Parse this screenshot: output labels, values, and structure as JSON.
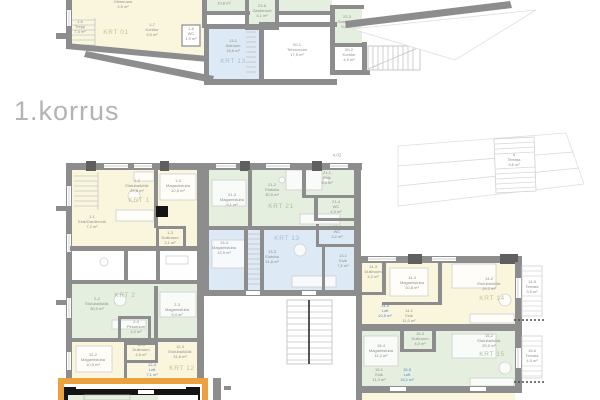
{
  "title": {
    "floor_label": "1.korrus"
  },
  "colors": {
    "background": "#ffffff",
    "wall_gray": "#8d8d8d",
    "wall_dark_pier": "#5f5f5f",
    "selected_wall_black": "#141414",
    "apartment_yellow": "#faf6dd",
    "apartment_green": "#e4efdf",
    "apartment_blue": "#dde9f4",
    "highlight_orange": "#eaa13e",
    "room_text_gray": "#8e8e8e",
    "loft_text_blue": "#5b7ec7",
    "krt_label_yellow": "#cdc091",
    "krt_label_green": "#a6c49f",
    "krt_label_blue": "#a3bed9",
    "title_gray": "#b3b3b3"
  },
  "apartments": [
    {
      "id": "KRT 01",
      "fill": "yellow",
      "plan": "upper"
    },
    {
      "id": "KRT 13",
      "fill": "blue",
      "plan": "upper"
    },
    {
      "id": "KRT 1",
      "fill": "yellow",
      "plan": "lower"
    },
    {
      "id": "KRT 2",
      "fill": "green",
      "plan": "lower"
    },
    {
      "id": "KRT 12",
      "fill": "yellow",
      "plan": "lower"
    },
    {
      "id": "KRT 21",
      "fill": "green",
      "plan": "lower"
    },
    {
      "id": "KRT 13",
      "fill": "blue",
      "plan": "lower"
    },
    {
      "id": "KRT 14",
      "fill": "yellow",
      "plan": "lower"
    },
    {
      "id": "KRT 15",
      "fill": "green",
      "plan": "lower"
    }
  ],
  "labels": [
    {
      "id": "room-1-08-olmeruum",
      "x": 123,
      "y": 2,
      "lines": [
        "1-08",
        "Olmeruum",
        "2,5 m²"
      ]
    },
    {
      "id": "room-1-6-trepp",
      "x": 80,
      "y": 27,
      "lines": [
        "1-6",
        "Trepp",
        "7,4 m²"
      ]
    },
    {
      "id": "apt-label-krt-01",
      "x": 116,
      "y": 33,
      "lines": [
        "KRT 01"
      ],
      "cls": "apt-yellow"
    },
    {
      "id": "room-1-7-koridor",
      "x": 152,
      "y": 30,
      "lines": [
        "1-7",
        "Koridor",
        "9,5 m²"
      ]
    },
    {
      "id": "room-1-8-wc",
      "x": 191,
      "y": 34,
      "lines": [
        "1-8",
        "WC",
        "1,9 m²"
      ]
    },
    {
      "id": "room-upper-cut-area",
      "x": 224,
      "y": 4,
      "lines": [
        "10,8 m²"
      ]
    },
    {
      "id": "room-23-6-garderoob",
      "x": 262,
      "y": 11,
      "lines": [
        "23-6",
        "Garderoob",
        "4,1 m²"
      ]
    },
    {
      "id": "room-22-3-garderoob",
      "x": 347,
      "y": 22,
      "lines": [
        "22-3",
        "Garderoob",
        "5,8 m²"
      ]
    },
    {
      "id": "room-13-1-abiruum",
      "x": 233,
      "y": 46,
      "lines": [
        "13-1",
        "Abiruum",
        "16,6 m²"
      ]
    },
    {
      "id": "apt-label-krt-13-upper",
      "x": 233,
      "y": 62,
      "lines": [
        "KRT 13"
      ],
      "cls": "apt-blue"
    },
    {
      "id": "room-00-1-tehnoruum",
      "x": 297,
      "y": 50,
      "lines": [
        "00-1",
        "Tehnoruum",
        "17,5 m²"
      ]
    },
    {
      "id": "room-00-2-koridor",
      "x": 349,
      "y": 55,
      "lines": [
        "00-2",
        "Koridor",
        "4,5 m²"
      ]
    },
    {
      "id": "level-marker-4-02",
      "x": 337,
      "y": 155,
      "lines": [
        "4.02"
      ],
      "cls": "marker"
    },
    {
      "id": "roof-terrace",
      "x": 514,
      "y": 160,
      "lines": [
        "6",
        "Terrass",
        "9,6 m²"
      ]
    },
    {
      "id": "room-1-2-elutuba",
      "x": 137,
      "y": 186,
      "lines": [
        "1-2",
        "Elutuba/köök",
        "29,6 m²"
      ]
    },
    {
      "id": "apt-label-krt-1",
      "x": 139,
      "y": 201,
      "lines": [
        "KRT 1"
      ],
      "cls": "apt-yellow"
    },
    {
      "id": "room-1-4-magamistuba",
      "x": 178,
      "y": 186,
      "lines": [
        "1-4",
        "Magamistuba",
        "10,5 m²"
      ]
    },
    {
      "id": "room-1-1-esik",
      "x": 92,
      "y": 222,
      "lines": [
        "1-1",
        "Esik/Garderoob",
        "7,2 m²"
      ]
    },
    {
      "id": "room-1-3-dusiruum",
      "x": 170,
      "y": 238,
      "lines": [
        "1-3",
        "Duširuum",
        "3,1 m²"
      ]
    },
    {
      "id": "room-2-2-elutuba",
      "x": 97,
      "y": 304,
      "lines": [
        "2-2",
        "Elutuba/köök",
        "30,0 m²"
      ]
    },
    {
      "id": "apt-label-krt-2",
      "x": 125,
      "y": 296,
      "lines": [
        "KRT 2"
      ],
      "cls": "apt-green"
    },
    {
      "id": "room-2-3-magamistuba",
      "x": 177,
      "y": 310,
      "lines": [
        "2-3",
        "Magamistuba",
        "9,4 m²"
      ]
    },
    {
      "id": "room-2-4-pesuruum",
      "x": 136,
      "y": 327,
      "lines": [
        "2-4",
        "Pesuruum",
        "4,0 m²"
      ]
    },
    {
      "id": "room-12-2-magamistuba",
      "x": 93,
      "y": 360,
      "lines": [
        "12-2",
        "Magamistuba",
        "10,9 m²"
      ]
    },
    {
      "id": "room-12-5-dusiruum",
      "x": 141,
      "y": 350,
      "lines": [
        "12-5",
        "Duširuum",
        "4,5 m²"
      ]
    },
    {
      "id": "room-12-4-loft",
      "x": 152,
      "y": 370,
      "lines": [
        "12-4",
        "Loft",
        "7,1 m²"
      ],
      "cls": "loft"
    },
    {
      "id": "room-12-3-elutuba",
      "x": 180,
      "y": 352,
      "lines": [
        "12-3",
        "Elutuba/köök",
        "31,8 m²"
      ]
    },
    {
      "id": "apt-label-krt-12",
      "x": 182,
      "y": 369,
      "lines": [
        "KRT 12"
      ],
      "cls": "apt-yellow"
    },
    {
      "id": "room-21-3-magamistuba",
      "x": 232,
      "y": 200,
      "lines": [
        "21-3",
        "Magamistuba",
        "9,1 m²"
      ]
    },
    {
      "id": "room-21-2-elutuba",
      "x": 272,
      "y": 190,
      "lines": [
        "21-2",
        "Elutuba",
        "30,5 m²"
      ]
    },
    {
      "id": "apt-label-krt-21",
      "x": 281,
      "y": 207,
      "lines": [
        "KRT 21"
      ],
      "cls": "apt-green"
    },
    {
      "id": "room-21-1-esik",
      "x": 327,
      "y": 178,
      "lines": [
        "21-1",
        "Esik",
        "6,0 m²"
      ]
    },
    {
      "id": "room-21-4-wc",
      "x": 336,
      "y": 207,
      "lines": [
        "21-4",
        "WC",
        "4,3 m²"
      ]
    },
    {
      "id": "room-13-4-magamistuba",
      "x": 224,
      "y": 248,
      "lines": [
        "13-4",
        "Magamistuba",
        "13,5 m²"
      ]
    },
    {
      "id": "apt-label-krt-13",
      "x": 287,
      "y": 239,
      "lines": [
        "KRT 13"
      ],
      "cls": "apt-blue"
    },
    {
      "id": "room-13-3-elutuba",
      "x": 272,
      "y": 257,
      "lines": [
        "13-3",
        "Elutuba",
        "31,8 m²"
      ]
    },
    {
      "id": "room-13-2-wc",
      "x": 337,
      "y": 232,
      "lines": [
        "13-2",
        "WC",
        "3,2 m²"
      ]
    },
    {
      "id": "room-13-1-esik",
      "x": 343,
      "y": 261,
      "lines": [
        "13-1",
        "Esik",
        "7,6 m²"
      ]
    },
    {
      "id": "room-14-3-dusiruum",
      "x": 373,
      "y": 272,
      "lines": [
        "14-3",
        "Duširuum",
        "4,2 m²"
      ]
    },
    {
      "id": "room-14-4-magamistuba",
      "x": 412,
      "y": 283,
      "lines": [
        "14-4",
        "Magamistuba",
        "10,8 m²"
      ]
    },
    {
      "id": "room-14-5-loft",
      "x": 385,
      "y": 311,
      "lines": [
        "14-5",
        "Loft",
        "10,5 m²"
      ],
      "cls": "loft"
    },
    {
      "id": "room-14-1-esik",
      "x": 409,
      "y": 316,
      "lines": [
        "14-1",
        "Esik",
        "11,0 m²"
      ]
    },
    {
      "id": "room-14-2-elutuba",
      "x": 489,
      "y": 284,
      "lines": [
        "14-2",
        "Elutuba/köök",
        "29,2 m²"
      ]
    },
    {
      "id": "apt-label-krt-14",
      "x": 492,
      "y": 299,
      "lines": [
        "KRT 14"
      ],
      "cls": "apt-yellow"
    },
    {
      "id": "terrace-14-6",
      "x": 532,
      "y": 287,
      "lines": [
        "14-6",
        "Terrass",
        "3,5 m²"
      ]
    },
    {
      "id": "room-15-3-dusiruum",
      "x": 420,
      "y": 339,
      "lines": [
        "15-3",
        "Duširuum",
        "4,0 m²"
      ]
    },
    {
      "id": "room-15-4-magamistuba",
      "x": 381,
      "y": 351,
      "lines": [
        "15-4",
        "Magamistuba",
        "11,2 m²"
      ]
    },
    {
      "id": "room-15-1-esik",
      "x": 379,
      "y": 375,
      "lines": [
        "15-1",
        "Esik",
        "11,3 m²"
      ]
    },
    {
      "id": "room-15-5-loft",
      "x": 407,
      "y": 375,
      "lines": [
        "15-5",
        "Loft",
        "16,1 m²"
      ],
      "cls": "loft"
    },
    {
      "id": "room-15-2-elutuba",
      "x": 489,
      "y": 341,
      "lines": [
        "15-2",
        "Elutuba/köök",
        "29,0 m²"
      ]
    },
    {
      "id": "apt-label-krt-15",
      "x": 492,
      "y": 355,
      "lines": [
        "KRT 15"
      ],
      "cls": "apt-green"
    },
    {
      "id": "terrace-15-6",
      "x": 532,
      "y": 356,
      "lines": [
        "15-6",
        "Terrass",
        "4,5 m²"
      ]
    }
  ]
}
